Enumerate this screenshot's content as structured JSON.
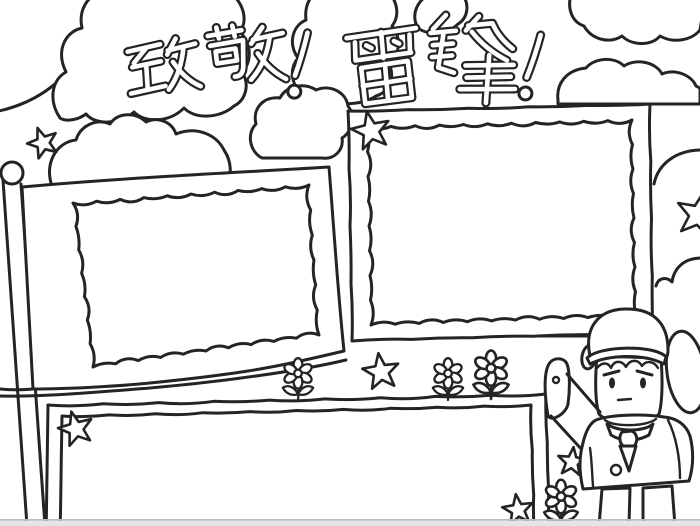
{
  "page": {
    "kind": "hand-drawn newspaper coloring template",
    "background_color": "#ffffff",
    "line_color": "#242424",
    "photo_edge_color": "#b9bdc1"
  },
  "title": {
    "text": "致敬！雷锋！",
    "chars": [
      "致",
      "敬",
      "！",
      "雷",
      "锋",
      "！"
    ],
    "style": "hollow-outline-bubble-lettering"
  },
  "frames": [
    {
      "name": "flag-text-frame",
      "shape": "flag-on-pole-with-scalloped-border",
      "content": ""
    },
    {
      "name": "right-text-frame",
      "shape": "rectangle-with-scalloped-border",
      "content": ""
    },
    {
      "name": "bottom-text-frame",
      "shape": "rectangle-double-border",
      "content": ""
    }
  ],
  "decorations": {
    "clouds": 11,
    "stars": 7,
    "flowers": 4
  },
  "character": {
    "name": "saluting-boy",
    "hat": "lei-feng-winter-hat-with-ear-flaps",
    "pose": "salute",
    "neckwear": "knotted-scarf"
  }
}
